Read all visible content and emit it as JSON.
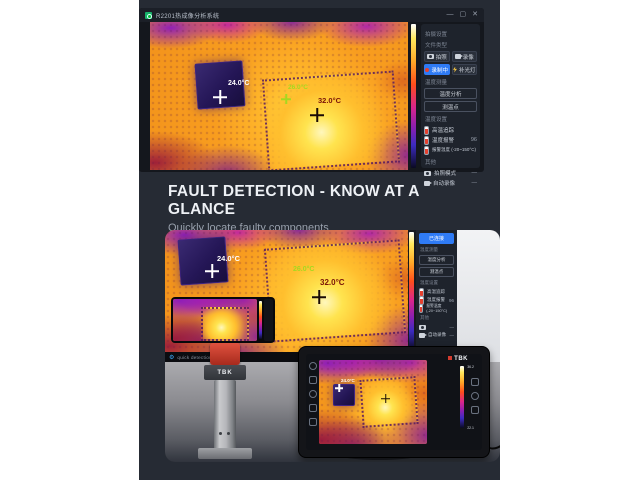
{
  "colors": {
    "accent_blue": "#2f7bf5",
    "record_red": "#e5402e",
    "green_label": "#a6d820",
    "hot_label": "#7a1408",
    "panel_dark": "#262b34",
    "brand_red": "#d23b2e"
  },
  "window": {
    "title": "R2201热成像分析系统",
    "controls": {
      "minimize": "—",
      "maximize": "▢",
      "close": "✕"
    }
  },
  "thermal_top": {
    "spot_left": "24.0°C",
    "spot_center": "26.0°C",
    "spot_hot": "32.0°C"
  },
  "sidebar_top": {
    "section_capture": "拍摄设置",
    "section_file": "文件类型",
    "btn_photo": "拍照",
    "btn_video": "录像",
    "btn_record": "录制中",
    "btn_light": "补光灯",
    "section_measure": "温度测量",
    "btn_analysis": "温度分析",
    "btn_point": "测温点",
    "section_temp": "温度设置",
    "rows": [
      {
        "label": "高温追踪",
        "value": ""
      },
      {
        "label": "温度报警",
        "value": "96"
      },
      {
        "label": "报警温度 (-20~150°C)",
        "value": ""
      }
    ],
    "section_other": "其他",
    "row_capture": {
      "label": "拍照模式",
      "value": "—"
    },
    "row_autorec": {
      "label": "自动录像",
      "value": "—"
    }
  },
  "headline": {
    "title": "FAULT DETECTION - KNOW AT A GLANCE",
    "subtitle": "Quickly locate faulty components"
  },
  "screen2": {
    "spot_left": "24.0°C",
    "spot_center": "26.0°C",
    "spot_hot": "32.0°C",
    "caption": "quick detection",
    "sidebar": {
      "btn_connected": "已连接",
      "section_measure": "温度测量",
      "btn_analysis": "温度分析",
      "btn_point": "测温点",
      "section_temp": "温度设置",
      "rows": [
        {
          "label": "高温追踪",
          "value": ""
        },
        {
          "label": "温度报警",
          "value": "96"
        },
        {
          "label": "报警温度 (-20~150°C)",
          "value": ""
        }
      ],
      "section_other": "其他",
      "row_capture": {
        "label": "拍照模式",
        "value": "—"
      },
      "row_autorec": {
        "label": "自动录像",
        "value": "—"
      }
    }
  },
  "photo": {
    "stand_brand": "TBK",
    "tablet_brand": "TBK",
    "tablet_spot": "24.0°C",
    "palette_max": "36.2",
    "palette_min": "22.1"
  },
  "icons": {
    "gear": "⚙"
  }
}
